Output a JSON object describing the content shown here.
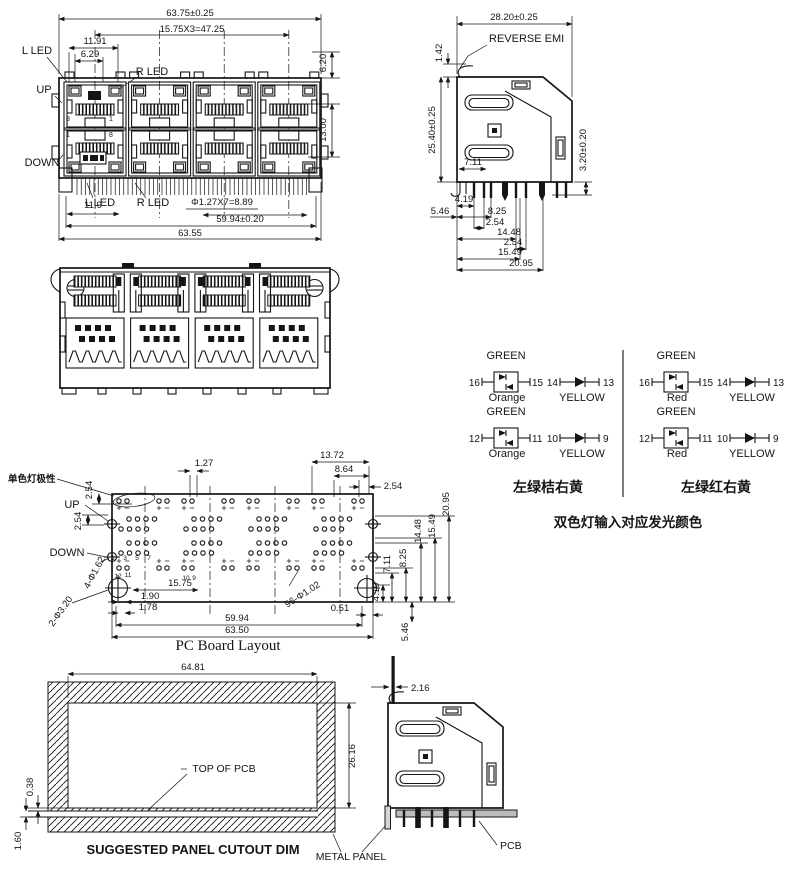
{
  "front": {
    "dim_overall": "63.75±0.25",
    "dim_pitch": "15.75X3=47.25",
    "dim_11_91": "11.91",
    "dim_6_29": "6.29",
    "dim_6_20": "6.20",
    "dim_13_00": "13.00",
    "dim_pin_pitch": "Φ1.27X7=8.89",
    "dim_59_94": "59.94±0.20",
    "dim_63_55": "63.55",
    "dim_11_9": "11.9",
    "l_led": "L LED",
    "r_led": "R LED",
    "up": "UP",
    "down": "DOWN",
    "pin8": "8",
    "pin1": "1"
  },
  "side": {
    "reverse_emi": "REVERSE EMI",
    "dim_width": "28.20±0.25",
    "dim_1_42": "1.42",
    "dim_height": "25.40±0.25",
    "dim_3_20": "3.20±0.20",
    "dim_7_11": "7.11",
    "dim_4_19": "4.19",
    "dim_5_46": "5.46",
    "dim_8_25": "8.25",
    "dim_2_54a": "2.54",
    "dim_14_48": "14.48",
    "dim_2_54b": "2.54",
    "dim_15_49": "15.49",
    "dim_20_95": "20.95"
  },
  "led": {
    "left": {
      "green": "GREEN",
      "n16": "16",
      "n15": "15",
      "n14": "14",
      "n13": "13",
      "n12": "12",
      "n11": "11",
      "n10": "10",
      "n9": "9",
      "color": "Orange",
      "yellow": "YELLOW",
      "caption": "左绿桔右黄"
    },
    "right": {
      "green": "GREEN",
      "n16": "16",
      "n15": "15",
      "n14": "14",
      "n13": "13",
      "n12": "12",
      "n11": "11",
      "n10": "10",
      "n9": "9",
      "color": "Red",
      "yellow": "YELLOW",
      "caption": "左绿红右黄"
    },
    "note": "双色灯输入对应发光颜色"
  },
  "pcb": {
    "title": "PC Board Layout",
    "polarity": "单色灯极性",
    "up": "UP",
    "down": "DOWN",
    "holes_led": "4-Φ1.62",
    "holes_mount": "2-Φ3.20",
    "holes_signal": "96-Φ1.02",
    "n1": "1",
    "n3": "3",
    "n5": "5",
    "n7": "7",
    "n9": "9",
    "n10": "10",
    "n11": "11",
    "n12": "12",
    "dim_1_27": "1.27",
    "dim_13_72": "13.72",
    "dim_8_64": "8.64",
    "dim_2_54a": "2.54",
    "dim_2_54b": "2.54",
    "dim_2_54c": "2.54",
    "dim_15_75": "15.75",
    "dim_1_90": "1.90",
    "dim_1_78": "1.78",
    "dim_59_94": "59.94",
    "dim_63_50": "63.50",
    "dim_0_51": "0.51",
    "dim_4_19": "4.19",
    "dim_5_46": "5.46",
    "dim_7_11": "7.11",
    "dim_8_25": "8.25",
    "dim_14_48": "14.48",
    "dim_15_49": "15.49",
    "dim_20_95": "20.95"
  },
  "panel": {
    "title": "SUGGESTED PANEL CUTOUT DIM",
    "top_of_pcb": "TOP OF PCB",
    "metal_panel": "METAL PANEL",
    "dim_64_81": "64.81",
    "dim_26_16": "26.16",
    "dim_0_38": "0.38",
    "dim_1_60": "1.60"
  },
  "mounted": {
    "pcb": "PCB",
    "dim_2_16": "2.16"
  }
}
